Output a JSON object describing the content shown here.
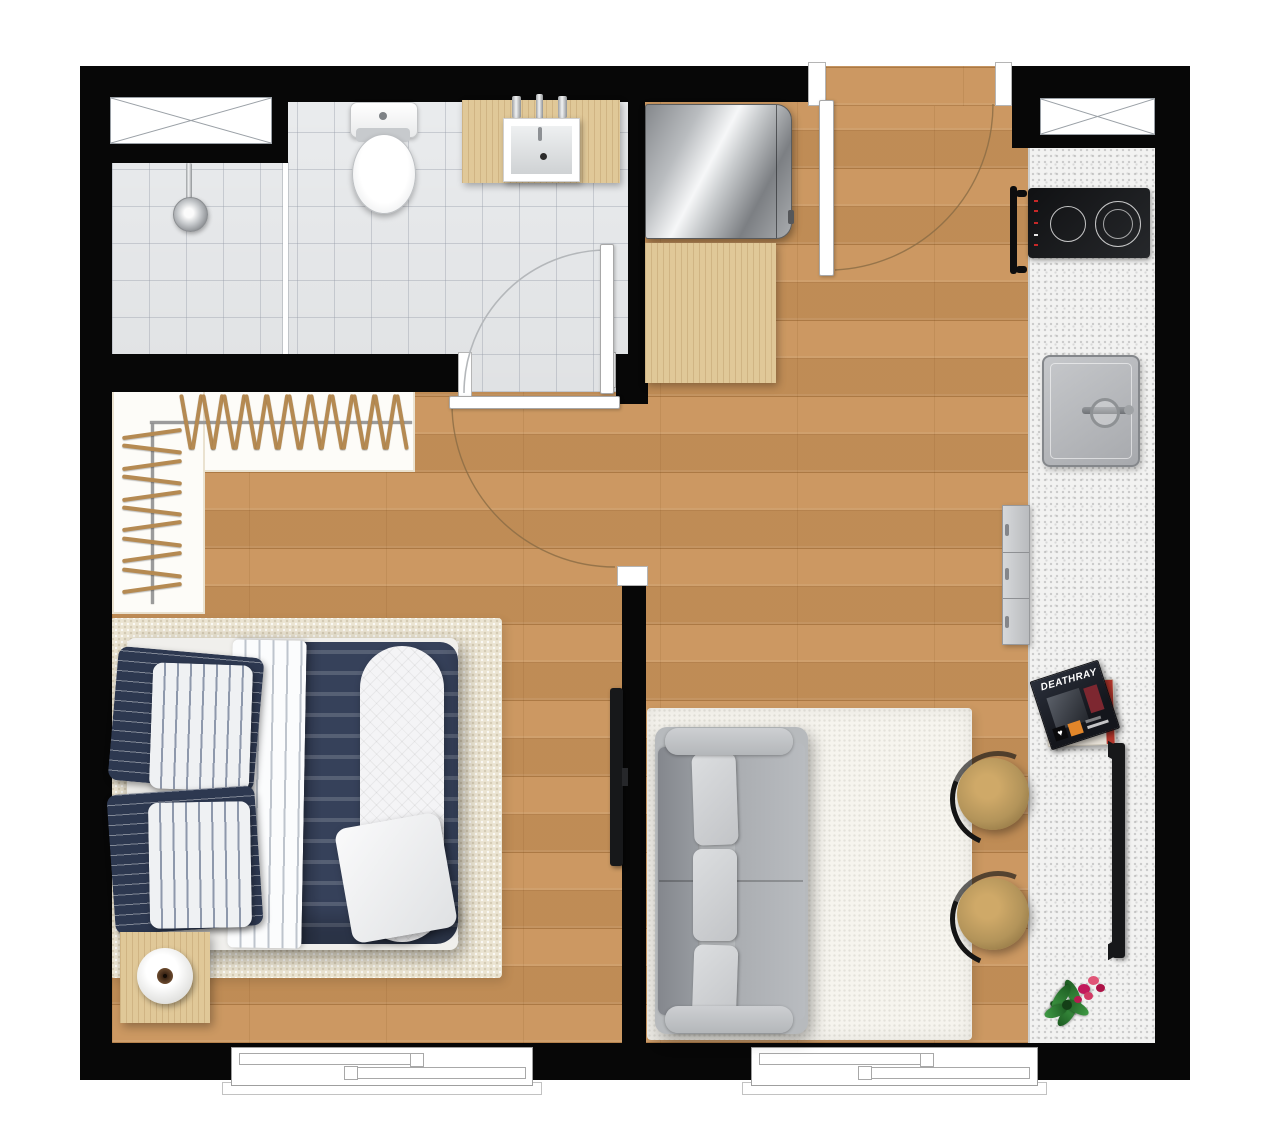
{
  "plan": {
    "kind": "apartment-floor-plan",
    "view": "top-down",
    "rooms": [
      "bathroom",
      "walk-in-closet",
      "bedroom",
      "living-room",
      "kitchen",
      "entry-hall",
      "balcony-windows"
    ]
  },
  "colors": {
    "wall": "#070707",
    "wood": "#c9935a",
    "cabinet-wood": "#e0c898",
    "tile": "#eef0f2",
    "counter": "#f2f2f1",
    "closet-floor": "#fdfcf8",
    "rug-living": "#f6f4ee",
    "rug-bedroom": "#ebe4d2",
    "navy": "#36415a",
    "navy-dark": "#2d3850",
    "sofa": "#b7babd",
    "stool": "#b3945a",
    "hanger": "#b58a52",
    "accent-red": "#c62828",
    "arc-wood": "#8a6b45",
    "arc-tile": "#b4b7ba"
  },
  "magazine": {
    "title": "DEATHRAY"
  },
  "closet": {
    "top_hanger_count": 21,
    "top_start_x": 184,
    "top_step": 10.8,
    "top_y": 394,
    "left_hanger_count": 11,
    "left_start_y": 432,
    "left_step": 15.4,
    "left_x": 122
  },
  "fixtures": {
    "bathroom": [
      "shower-head",
      "toilet",
      "vanity-sink",
      "bathroom-window"
    ],
    "kitchen": [
      "two-burner-cooktop",
      "counter-sink",
      "dishwasher-drawer",
      "oven-handle",
      "kitchen-window"
    ],
    "living": [
      "sofa-3-seat",
      "shag-rug",
      "bar-stool",
      "bar-stool",
      "tv-on-sideboard",
      "magazine-stack",
      "flower-pot"
    ],
    "bedroom": [
      "double-bed",
      "area-rug",
      "nightstand-with-lamp",
      "wall-tv",
      "balcony-window"
    ],
    "entry": [
      "mirrored-cabinet",
      "wood-bench",
      "entry-door"
    ]
  }
}
